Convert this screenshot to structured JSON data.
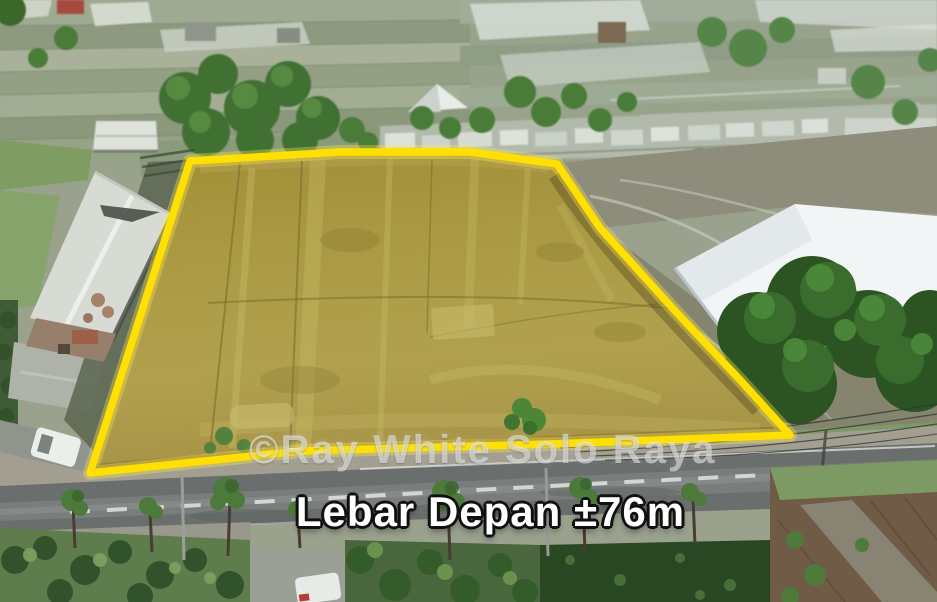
{
  "photo": {
    "watermark": "©Ray White Solo Raya",
    "caption": "Lebar Depan ±76m"
  },
  "colors": {
    "boundary": "#FFE000",
    "plot_field": "#A99741",
    "caption_fill": "#FFFFFF",
    "caption_outline": "#111111",
    "watermark": "#FFFFFF"
  }
}
